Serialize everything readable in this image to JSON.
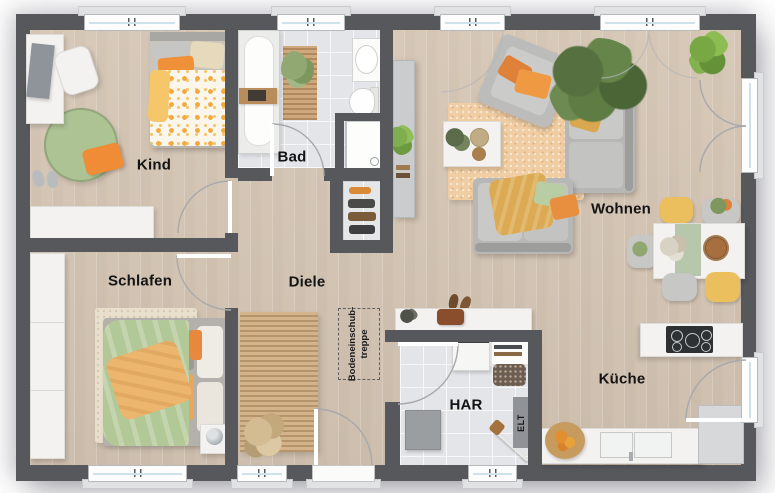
{
  "rooms": {
    "kind": {
      "label": "Kind"
    },
    "bad": {
      "label": "Bad"
    },
    "wohnen": {
      "label": "Wohnen"
    },
    "schlafen": {
      "label": "Schlafen"
    },
    "diele": {
      "label": "Diele"
    },
    "har": {
      "label": "HAR"
    },
    "kueche": {
      "label": "Küche"
    }
  },
  "annotations": {
    "attic_line1": "Bodeneinschub-",
    "attic_line2": "treppe",
    "elt": "ELT"
  },
  "colors": {
    "wall": "#56585c",
    "wood_floor": "#d7c8b7",
    "tile_floor": "#e3e5e8",
    "accent_orange": "#e78f3f",
    "accent_green": "#a9c08e",
    "accent_yellow": "#ecbf5e",
    "furniture_white": "#f3f2f0"
  }
}
